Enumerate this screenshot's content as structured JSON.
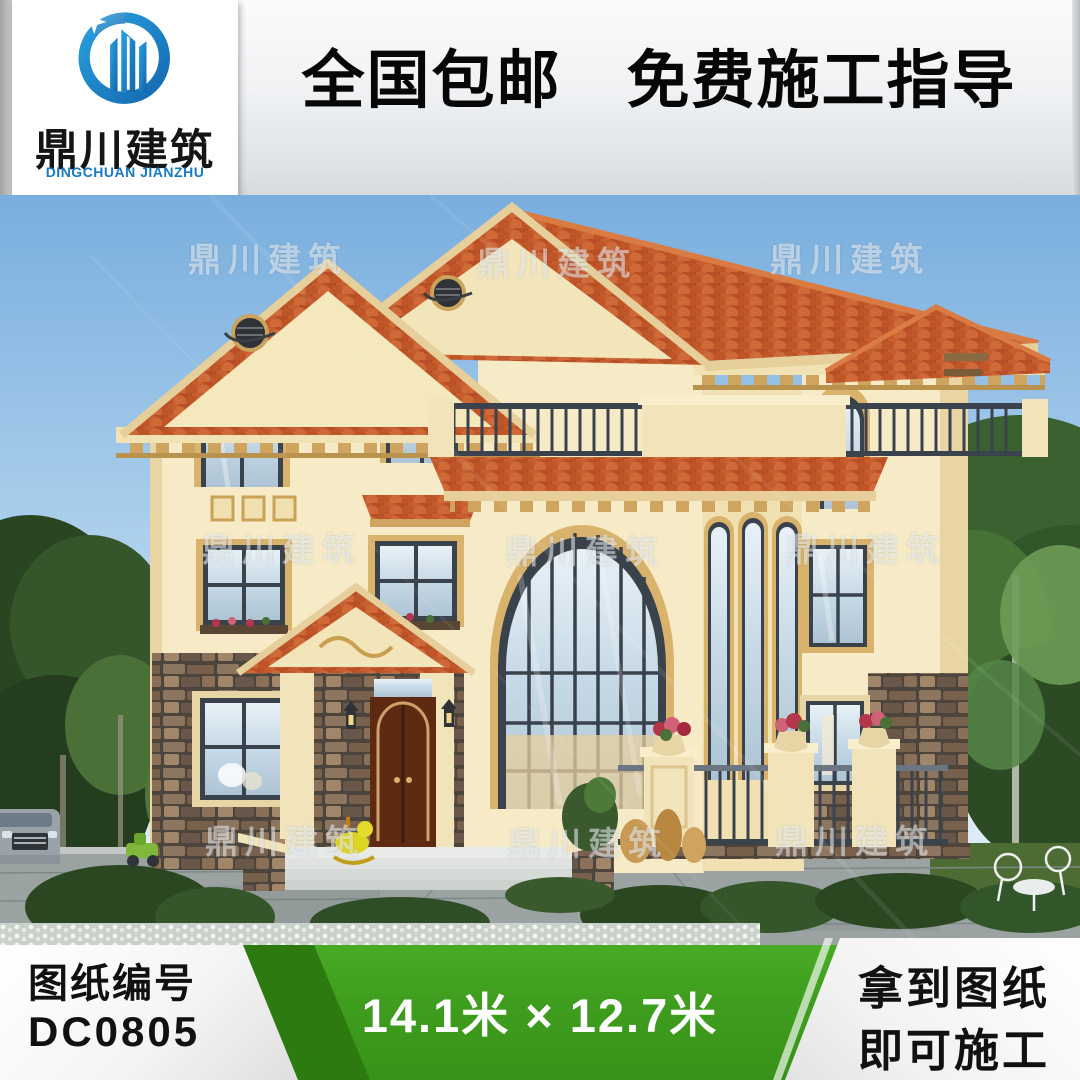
{
  "logo": {
    "cn": "鼎川建筑",
    "en": "DINGCHUAN JIANZHU"
  },
  "banner": {
    "text": "全国包邮　免费施工指导"
  },
  "watermark": {
    "text": "鼎川建筑"
  },
  "footer": {
    "left": {
      "label": "图纸编号",
      "code": "DC0805"
    },
    "center": {
      "size_text": "14.1米 × 12.7米"
    },
    "right": {
      "line1": "拿到图纸",
      "line2": "即可施工"
    }
  },
  "colors": {
    "accent_green": "#3f9e1e",
    "roof_red": "#b2491f",
    "wall_cream": "#f6ebc6",
    "logo_blue": "#1b85c5",
    "sky_blue": "#7fb3e2"
  }
}
